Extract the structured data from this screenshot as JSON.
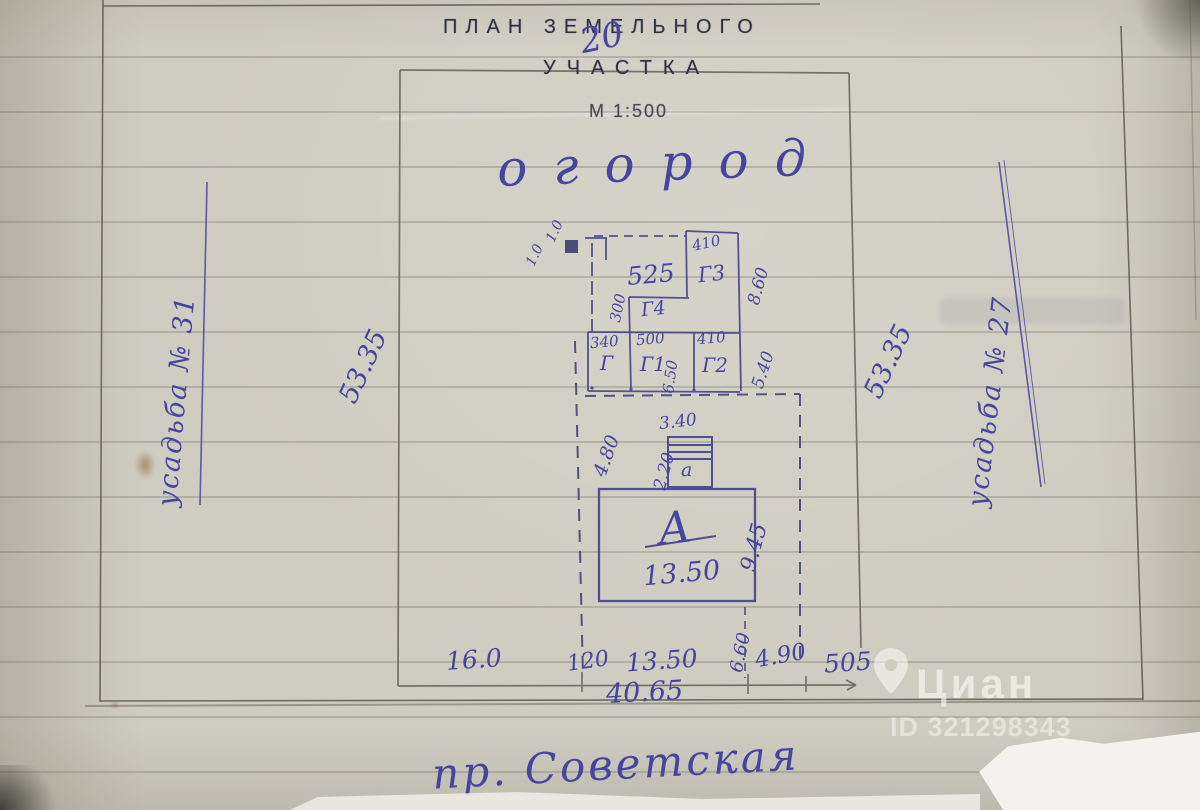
{
  "document": {
    "title_line1": "ПЛАН ЗЕМЕЛЬНОГО",
    "title_line2": "УЧАСТКА",
    "scale": "М 1:500",
    "plot_number_overlay": "20"
  },
  "plot": {
    "garden_label": "огород",
    "street_label": "пр. Советская",
    "left_margin_note": "усадьба № 31",
    "right_margin_note": "усадьба № 27",
    "side_left": "53.35",
    "side_right": "53.35",
    "bottom_segments": [
      "16.0",
      "120",
      "13.50",
      "4.90",
      "505"
    ],
    "bottom_total": "40.65",
    "house_offset_right": "6.60"
  },
  "outbuildings": {
    "corner_square": {
      "dim_a": "1.0",
      "dim_b": "1.0"
    },
    "g3": {
      "label": "Г3",
      "width": "410",
      "height": "8.60"
    },
    "mid": {
      "width": "525",
      "height": "300"
    },
    "g4": {
      "label": "Г4"
    },
    "row": {
      "height": "5.40",
      "inner_height": "6.50",
      "cells": [
        {
          "label": "Г",
          "width": "340"
        },
        {
          "label": "Г1",
          "width": "500"
        },
        {
          "label": "Г2",
          "width": "410"
        }
      ]
    }
  },
  "annex": {
    "label": "а",
    "width": "3.40",
    "offset_side": "2.20",
    "offset_top": "4.80"
  },
  "house": {
    "label": "А",
    "width": "13.50",
    "depth": "9.45"
  },
  "watermark": {
    "brand": "Циан",
    "id": "ID 321298343"
  }
}
